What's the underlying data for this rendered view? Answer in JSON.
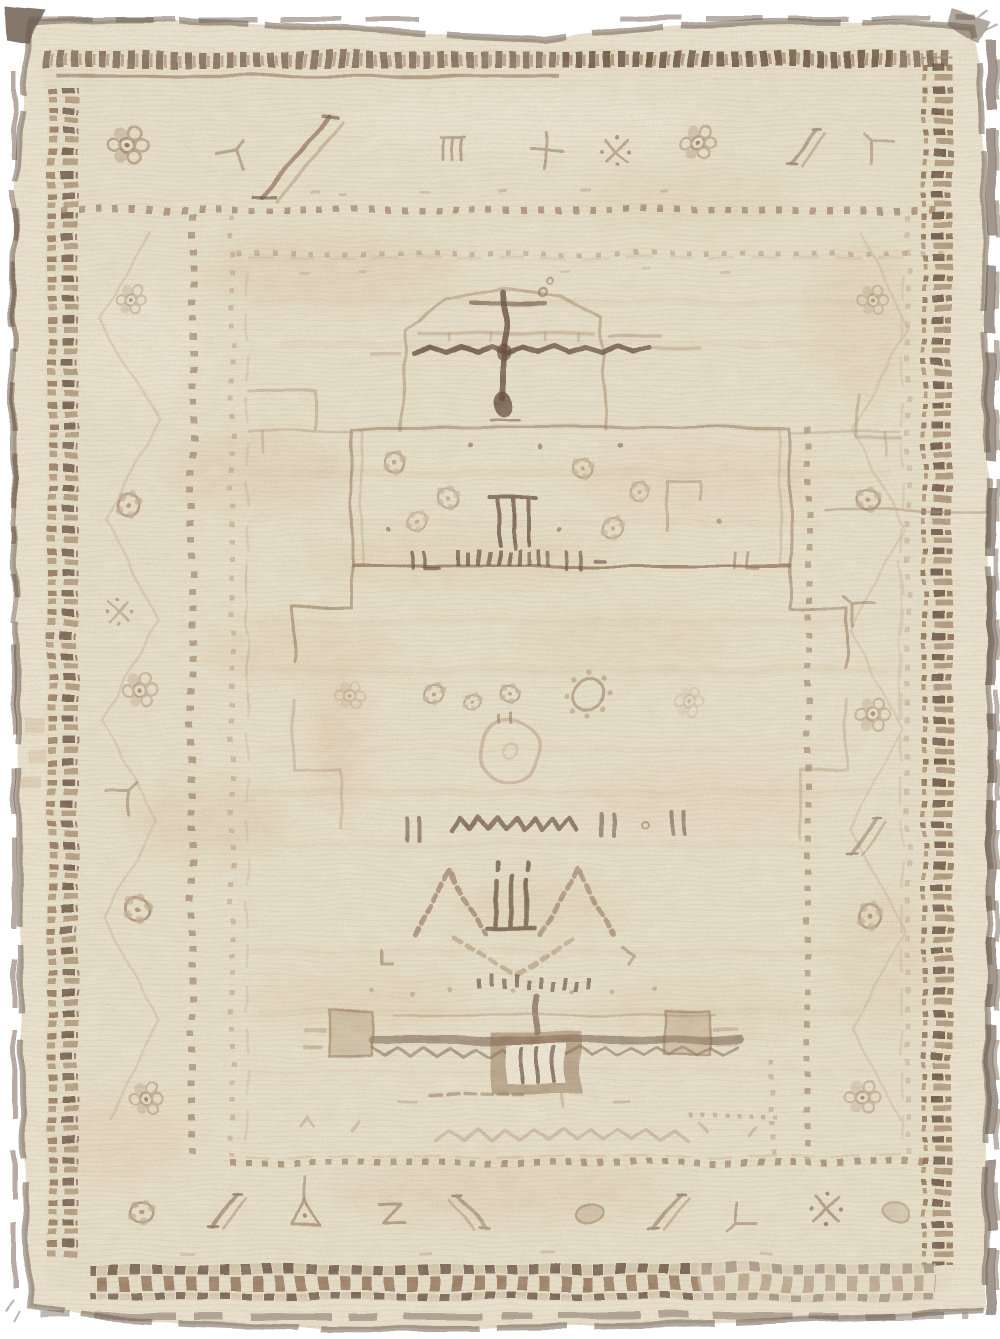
{
  "image": {
    "type": "photograph",
    "title": "Antique beige and brown tribal wool rug",
    "alt": "Worn hand-knotted cream wool rug with faded brown geometric borders, brown checkered guard bands, dotted guard stripes, and a pale open field holding a faded arch and cross motif at top, a flower panel, a round medallion, a zigzag bar, diamond gables and a stepped cross near the bottom",
    "visible_text": []
  },
  "palette": {
    "page": "#ffffff",
    "wool_base": "#e9e1c8",
    "wool_light": "#f2ecd9",
    "wool_margin": "#ece5cf",
    "tan": "#d8c2a0",
    "blush": "#e4c9ad",
    "brown_dark": "#5f4634",
    "brown_mid": "#8a684a",
    "brown_soft": "#a98d6e",
    "brown_faint": "#c3ad92",
    "red_brown": "#a97f63",
    "selvage": "#6f5f51",
    "selvage_gray": "#8d8072"
  },
  "composition": {
    "bands_outside_in": [
      "dark selvage edge",
      "plain cream outer margin",
      "brown dash and checker guard bands on all four sides",
      "main border of faded rosettes, diagonal slashes and hook motifs",
      "dotted guard stripes",
      "open cream field"
    ],
    "field_motifs_top_to_bottom": [
      "arched gable with dark zigzag cross bar and hanging pole",
      "rectangular panel with flower clusters and three-bar lamp",
      "stepped meander hooks on both sides",
      "rosette row with gear flower",
      "faded circular medallion",
      "zigzag bar with bracket marks",
      "two diamond-lattice gables flanking a three-pronged standard",
      "stepped cross with light inner square",
      "small diamond chain"
    ],
    "condition": "heavily faded and abraded pile with horizontal abrash streaks"
  }
}
